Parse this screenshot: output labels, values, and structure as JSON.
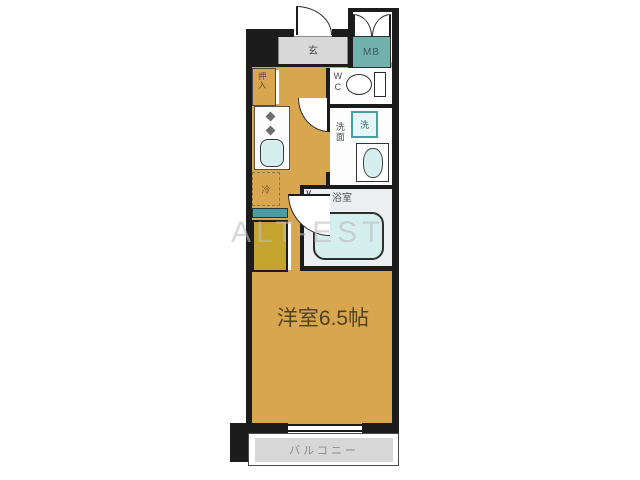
{
  "watermark": {
    "text": "ALT-EST"
  },
  "rooms": {
    "genkan_label": "玄",
    "mb_label": "MB",
    "wc_label": "WC",
    "washer_label": "洗",
    "washroom_label": "洗面",
    "bathroom_label": "浴室",
    "closet_label": "押入",
    "fridge_label": "冷",
    "main_room_label": "洋室6.5帖",
    "balcony_label": "バルコニー",
    "bath_door_mark": "∨"
  },
  "colors": {
    "floor_tan": "#d7a64e",
    "genkan_gray": "#d8d8d8",
    "balcony_gray": "#d7d7d7",
    "mb_teal": "#72b2ad",
    "fixture_cyan": "#d5efef",
    "washer_teal_border": "#48a0a0",
    "closet_yellow": "#c4a42c",
    "shelf_teal": "#4e9aa0",
    "wall_black": "#1c1c1c",
    "watermark_gray": "#bdbdbd"
  }
}
